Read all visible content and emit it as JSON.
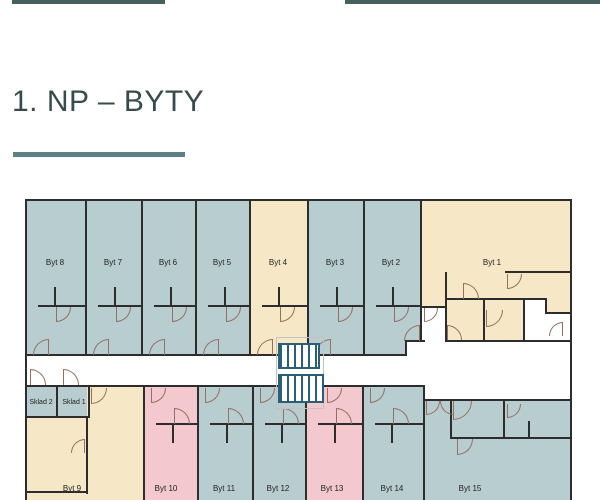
{
  "page": {
    "title": "1. NP – BYTY",
    "accent_bar_color": "#45605f",
    "underline_color": "#5c8184",
    "title_color": "#374b4d"
  },
  "plan": {
    "colors": {
      "unit_blue": "#b8cdd0",
      "unit_cream": "#f6e8c6",
      "unit_pink": "#f3c8cf",
      "wall": "#2d2d2d",
      "door_arc": "#96705f",
      "stairs": "#2b5f79",
      "corridor": "#ffffff"
    },
    "rooms": [
      {
        "id": "byt-8",
        "x": 25,
        "y": 200,
        "w": 60,
        "h": 156,
        "color": "unit_blue"
      },
      {
        "id": "byt-7",
        "x": 85,
        "y": 200,
        "w": 56,
        "h": 156,
        "color": "unit_blue"
      },
      {
        "id": "byt-6",
        "x": 141,
        "y": 200,
        "w": 54,
        "h": 156,
        "color": "unit_blue"
      },
      {
        "id": "byt-5",
        "x": 195,
        "y": 200,
        "w": 54,
        "h": 156,
        "color": "unit_blue"
      },
      {
        "id": "byt-4",
        "x": 249,
        "y": 200,
        "w": 58,
        "h": 156,
        "color": "unit_cream"
      },
      {
        "id": "byt-3",
        "x": 307,
        "y": 200,
        "w": 56,
        "h": 156,
        "color": "unit_blue"
      },
      {
        "id": "byt-2",
        "x": 363,
        "y": 200,
        "w": 57,
        "h": 142,
        "color": "unit_blue"
      },
      {
        "id": "byt-2-entry",
        "x": 363,
        "y": 342,
        "w": 42,
        "h": 14,
        "color": "unit_blue"
      },
      {
        "id": "byt-1",
        "x": 420,
        "y": 200,
        "w": 152,
        "h": 142,
        "color": "unit_cream"
      },
      {
        "id": "sklad-2",
        "x": 25,
        "y": 387,
        "w": 33,
        "h": 31,
        "color": "unit_blue"
      },
      {
        "id": "sklad-1",
        "x": 58,
        "y": 387,
        "w": 32,
        "h": 31,
        "color": "unit_blue"
      },
      {
        "id": "byt-9-a",
        "x": 25,
        "y": 418,
        "w": 62,
        "h": 82,
        "color": "unit_cream"
      },
      {
        "id": "byt-9-b",
        "x": 87,
        "y": 387,
        "w": 56,
        "h": 113,
        "color": "unit_cream"
      },
      {
        "id": "byt-10",
        "x": 143,
        "y": 387,
        "w": 54,
        "h": 113,
        "color": "unit_pink"
      },
      {
        "id": "byt-11",
        "x": 197,
        "y": 387,
        "w": 55,
        "h": 113,
        "color": "unit_blue"
      },
      {
        "id": "byt-12",
        "x": 252,
        "y": 387,
        "w": 53,
        "h": 113,
        "color": "unit_blue"
      },
      {
        "id": "byt-13",
        "x": 305,
        "y": 387,
        "w": 57,
        "h": 113,
        "color": "unit_pink"
      },
      {
        "id": "byt-14",
        "x": 362,
        "y": 387,
        "w": 61,
        "h": 113,
        "color": "unit_blue"
      },
      {
        "id": "byt-15",
        "x": 423,
        "y": 400,
        "w": 149,
        "h": 100,
        "color": "unit_blue"
      }
    ],
    "white_areas": [
      {
        "id": "byt1-vestibule",
        "x": 421,
        "y": 307,
        "w": 24,
        "h": 35
      },
      {
        "id": "byt1-tech-left",
        "x": 525,
        "y": 300,
        "w": 22,
        "h": 42
      },
      {
        "id": "byt1-tech-right",
        "x": 547,
        "y": 313,
        "w": 25,
        "h": 29
      }
    ],
    "walls": [
      {
        "x": 25,
        "y": 199,
        "w": 547,
        "h": 2
      },
      {
        "x": 25,
        "y": 199,
        "w": 2,
        "h": 301
      },
      {
        "x": 570,
        "y": 199,
        "w": 2,
        "h": 301
      },
      {
        "x": 85,
        "y": 199,
        "w": 2,
        "h": 157
      },
      {
        "x": 141,
        "y": 199,
        "w": 2,
        "h": 157
      },
      {
        "x": 195,
        "y": 199,
        "w": 2,
        "h": 157
      },
      {
        "x": 249,
        "y": 199,
        "w": 2,
        "h": 157
      },
      {
        "x": 307,
        "y": 199,
        "w": 2,
        "h": 157
      },
      {
        "x": 363,
        "y": 199,
        "w": 2,
        "h": 157
      },
      {
        "x": 420,
        "y": 199,
        "w": 2,
        "h": 143
      },
      {
        "x": 25,
        "y": 354,
        "w": 382,
        "h": 2
      },
      {
        "x": 405,
        "y": 341,
        "w": 2,
        "h": 15
      },
      {
        "x": 405,
        "y": 340,
        "w": 20,
        "h": 2
      },
      {
        "x": 445,
        "y": 340,
        "w": 127,
        "h": 2
      },
      {
        "x": 25,
        "y": 385,
        "w": 400,
        "h": 2
      },
      {
        "x": 423,
        "y": 385,
        "w": 2,
        "h": 16
      },
      {
        "x": 423,
        "y": 399,
        "w": 149,
        "h": 2
      },
      {
        "x": 38,
        "y": 305,
        "w": 47,
        "h": 2
      },
      {
        "x": 54,
        "y": 287,
        "w": 2,
        "h": 20
      },
      {
        "x": 98,
        "y": 305,
        "w": 43,
        "h": 2
      },
      {
        "x": 114,
        "y": 287,
        "w": 2,
        "h": 20
      },
      {
        "x": 154,
        "y": 305,
        "w": 41,
        "h": 2
      },
      {
        "x": 170,
        "y": 287,
        "w": 2,
        "h": 20
      },
      {
        "x": 208,
        "y": 305,
        "w": 41,
        "h": 2
      },
      {
        "x": 224,
        "y": 287,
        "w": 2,
        "h": 20
      },
      {
        "x": 262,
        "y": 305,
        "w": 45,
        "h": 2
      },
      {
        "x": 278,
        "y": 287,
        "w": 2,
        "h": 20
      },
      {
        "x": 320,
        "y": 305,
        "w": 43,
        "h": 2
      },
      {
        "x": 336,
        "y": 287,
        "w": 2,
        "h": 20
      },
      {
        "x": 376,
        "y": 305,
        "w": 44,
        "h": 2
      },
      {
        "x": 392,
        "y": 287,
        "w": 2,
        "h": 20
      },
      {
        "x": 445,
        "y": 272,
        "w": 2,
        "h": 70
      },
      {
        "x": 447,
        "y": 298,
        "w": 100,
        "h": 2
      },
      {
        "x": 505,
        "y": 271,
        "w": 67,
        "h": 2
      },
      {
        "x": 483,
        "y": 298,
        "w": 2,
        "h": 44
      },
      {
        "x": 523,
        "y": 298,
        "w": 2,
        "h": 44
      },
      {
        "x": 545,
        "y": 298,
        "w": 2,
        "h": 16
      },
      {
        "x": 545,
        "y": 312,
        "w": 27,
        "h": 2
      },
      {
        "x": 420,
        "y": 306,
        "w": 27,
        "h": 2
      },
      {
        "x": 143,
        "y": 385,
        "w": 2,
        "h": 115
      },
      {
        "x": 197,
        "y": 385,
        "w": 2,
        "h": 115
      },
      {
        "x": 252,
        "y": 385,
        "w": 2,
        "h": 115
      },
      {
        "x": 305,
        "y": 385,
        "w": 2,
        "h": 115
      },
      {
        "x": 362,
        "y": 385,
        "w": 2,
        "h": 115
      },
      {
        "x": 423,
        "y": 399,
        "w": 2,
        "h": 101
      },
      {
        "x": 56,
        "y": 385,
        "w": 2,
        "h": 33
      },
      {
        "x": 88,
        "y": 385,
        "w": 2,
        "h": 33
      },
      {
        "x": 25,
        "y": 416,
        "w": 65,
        "h": 2
      },
      {
        "x": 86,
        "y": 418,
        "w": 2,
        "h": 76
      },
      {
        "x": 25,
        "y": 491,
        "w": 63,
        "h": 2
      },
      {
        "x": 156,
        "y": 423,
        "w": 41,
        "h": 2
      },
      {
        "x": 172,
        "y": 423,
        "w": 2,
        "h": 20
      },
      {
        "x": 210,
        "y": 423,
        "w": 42,
        "h": 2
      },
      {
        "x": 226,
        "y": 423,
        "w": 2,
        "h": 20
      },
      {
        "x": 265,
        "y": 423,
        "w": 40,
        "h": 2
      },
      {
        "x": 281,
        "y": 423,
        "w": 2,
        "h": 20
      },
      {
        "x": 318,
        "y": 423,
        "w": 44,
        "h": 2
      },
      {
        "x": 334,
        "y": 423,
        "w": 2,
        "h": 20
      },
      {
        "x": 375,
        "y": 423,
        "w": 48,
        "h": 2
      },
      {
        "x": 391,
        "y": 423,
        "w": 2,
        "h": 20
      },
      {
        "x": 450,
        "y": 399,
        "w": 2,
        "h": 40
      },
      {
        "x": 450,
        "y": 437,
        "w": 55,
        "h": 2
      },
      {
        "x": 503,
        "y": 399,
        "w": 2,
        "h": 40
      },
      {
        "x": 503,
        "y": 437,
        "w": 69,
        "h": 2
      },
      {
        "x": 528,
        "y": 421,
        "w": 2,
        "h": 16
      }
    ],
    "doors": [
      {
        "x": 56,
        "y": 307,
        "s": 15,
        "c": "br"
      },
      {
        "x": 116,
        "y": 307,
        "s": 15,
        "c": "br"
      },
      {
        "x": 172,
        "y": 307,
        "s": 15,
        "c": "br"
      },
      {
        "x": 226,
        "y": 307,
        "s": 15,
        "c": "br"
      },
      {
        "x": 280,
        "y": 307,
        "s": 15,
        "c": "br"
      },
      {
        "x": 338,
        "y": 307,
        "s": 15,
        "c": "br"
      },
      {
        "x": 394,
        "y": 307,
        "s": 15,
        "c": "br"
      },
      {
        "x": 33,
        "y": 339,
        "s": 16,
        "c": "tl"
      },
      {
        "x": 93,
        "y": 339,
        "s": 16,
        "c": "tl"
      },
      {
        "x": 149,
        "y": 339,
        "s": 16,
        "c": "tl"
      },
      {
        "x": 203,
        "y": 339,
        "s": 16,
        "c": "tl"
      },
      {
        "x": 257,
        "y": 339,
        "s": 16,
        "c": "tl"
      },
      {
        "x": 315,
        "y": 339,
        "s": 16,
        "c": "tl"
      },
      {
        "x": 404,
        "y": 325,
        "s": 16,
        "c": "tl"
      },
      {
        "x": 463,
        "y": 283,
        "s": 16,
        "c": "tr"
      },
      {
        "x": 507,
        "y": 274,
        "s": 15,
        "c": "br"
      },
      {
        "x": 486,
        "y": 310,
        "s": 17,
        "c": "br"
      },
      {
        "x": 447,
        "y": 325,
        "s": 15,
        "c": "tr"
      },
      {
        "x": 549,
        "y": 322,
        "s": 14,
        "c": "tl"
      },
      {
        "x": 424,
        "y": 308,
        "s": 14,
        "c": "br"
      },
      {
        "x": 30,
        "y": 369,
        "s": 16,
        "c": "tr"
      },
      {
        "x": 63,
        "y": 369,
        "s": 16,
        "c": "tr"
      },
      {
        "x": 91,
        "y": 388,
        "s": 16,
        "c": "br"
      },
      {
        "x": 71,
        "y": 439,
        "s": 14,
        "c": "tl"
      },
      {
        "x": 151,
        "y": 388,
        "s": 15,
        "c": "br"
      },
      {
        "x": 205,
        "y": 388,
        "s": 15,
        "c": "br"
      },
      {
        "x": 260,
        "y": 388,
        "s": 15,
        "c": "br"
      },
      {
        "x": 327,
        "y": 388,
        "s": 15,
        "c": "br"
      },
      {
        "x": 370,
        "y": 388,
        "s": 15,
        "c": "br"
      },
      {
        "x": 174,
        "y": 408,
        "s": 16,
        "c": "tr"
      },
      {
        "x": 228,
        "y": 408,
        "s": 16,
        "c": "tr"
      },
      {
        "x": 283,
        "y": 408,
        "s": 16,
        "c": "tr"
      },
      {
        "x": 336,
        "y": 408,
        "s": 16,
        "c": "tr"
      },
      {
        "x": 393,
        "y": 408,
        "s": 16,
        "c": "tr"
      },
      {
        "x": 426,
        "y": 401,
        "s": 14,
        "c": "br"
      },
      {
        "x": 440,
        "y": 401,
        "s": 14,
        "c": "bl"
      },
      {
        "x": 453,
        "y": 401,
        "s": 19,
        "c": "br"
      },
      {
        "x": 457,
        "y": 439,
        "s": 16,
        "c": "br"
      },
      {
        "x": 507,
        "y": 404,
        "s": 14,
        "c": "br"
      }
    ],
    "stairs": [
      {
        "x": 278,
        "y": 343,
        "w": 42,
        "h": 26
      },
      {
        "x": 278,
        "y": 374,
        "w": 46,
        "h": 29
      }
    ],
    "stair_guide": {
      "x": 276,
      "y": 337,
      "w": 46,
      "h": 70
    },
    "labels": [
      {
        "text": "Byt 8",
        "x": 55,
        "y": 258,
        "fs": 8
      },
      {
        "text": "Byt 7",
        "x": 113,
        "y": 258,
        "fs": 8
      },
      {
        "text": "Byt 6",
        "x": 168,
        "y": 258,
        "fs": 8
      },
      {
        "text": "Byt 5",
        "x": 222,
        "y": 258,
        "fs": 8
      },
      {
        "text": "Byt 4",
        "x": 278,
        "y": 258,
        "fs": 8
      },
      {
        "text": "Byt 3",
        "x": 335,
        "y": 258,
        "fs": 8
      },
      {
        "text": "Byt 2",
        "x": 391,
        "y": 258,
        "fs": 8
      },
      {
        "text": "Byt 1",
        "x": 492,
        "y": 258,
        "fs": 8
      },
      {
        "text": "Sklad 2",
        "x": 41,
        "y": 399,
        "fs": 7
      },
      {
        "text": "Sklad 1",
        "x": 74,
        "y": 399,
        "fs": 7
      },
      {
        "text": "Byt 9",
        "x": 72,
        "y": 484,
        "fs": 8
      },
      {
        "text": "Byt 10",
        "x": 166,
        "y": 484,
        "fs": 8
      },
      {
        "text": "Byt 11",
        "x": 224,
        "y": 484,
        "fs": 8
      },
      {
        "text": "Byt 12",
        "x": 278,
        "y": 484,
        "fs": 8
      },
      {
        "text": "Byt 13",
        "x": 332,
        "y": 484,
        "fs": 8
      },
      {
        "text": "Byt 14",
        "x": 392,
        "y": 484,
        "fs": 8
      },
      {
        "text": "Byt 15",
        "x": 470,
        "y": 484,
        "fs": 8
      }
    ]
  }
}
